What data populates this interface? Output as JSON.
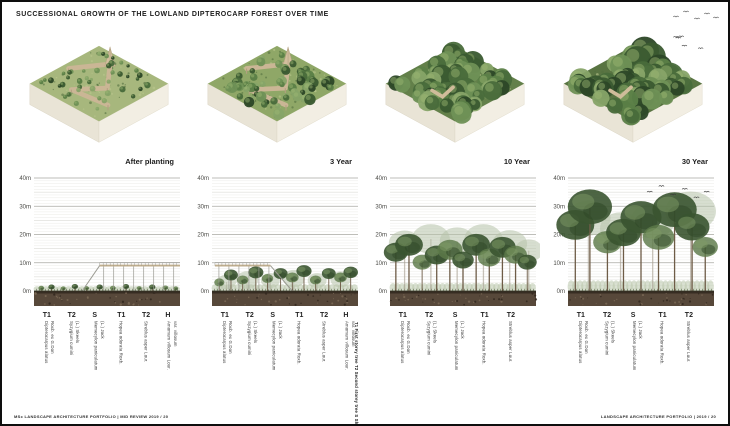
{
  "page": {
    "title": "SUCCESSIONAL GROWTH OF THE LOWLAND DIPTEROCARP FOREST OVER TIME",
    "footer_left": "MSc LANDSCAPE ARCHITECTURE PORTFOLIO  |  MID REVIEW 2019 / 20",
    "footer_right": "LANDSCAPE ARCHITECTURE PORTFOLIO  |  2019 / 20",
    "frame_color": "#0e0e0e",
    "background": "#ffffff",
    "corner_birds": 5
  },
  "layer_key": "T1 First storey tree   T2 Second storey tree   S Shrub   H Herbaceous layer",
  "colors": {
    "section_tones": {
      "dark": "#3a5430",
      "mid": "#5d7a49",
      "pale": "#b6c3aa"
    },
    "iso_palette": [
      "#2c4727",
      "#3a5a30",
      "#496c3b",
      "#5b7f47",
      "#6f9156",
      "#87a468"
    ],
    "boardwalk": "#cab695",
    "soil": "#57483a"
  },
  "panels": [
    {
      "label": "After planting",
      "iso": {
        "seed": 11,
        "ground": "#a7b77d",
        "blob_count": 46,
        "r_min": 1.5,
        "r_max": 3.2,
        "tall": 0,
        "boardwalk": true,
        "tower": true,
        "path_patch": false,
        "birds": false
      },
      "species": [
        {
          "code": "T1",
          "name": "Dipterocarpus alatus",
          "author": "Roxb. ex G.Don"
        },
        {
          "code": "T2",
          "name": "Syzygium cumini",
          "author": "(L.) Skeels"
        },
        {
          "code": "S",
          "name": "Memecylon paniculatum",
          "author": "(L.) Jack"
        },
        {
          "code": "T1",
          "name": "Hopea odorata Roxb.",
          "author": ""
        },
        {
          "code": "T2",
          "name": "Streblus asper Lour.",
          "author": ""
        },
        {
          "code": "H",
          "name": "Amomum villosum Lour.",
          "author": "var. villosum"
        }
      ]
    },
    {
      "label": "3 Year",
      "iso": {
        "seed": 22,
        "ground": "#8fa767",
        "blob_count": 64,
        "r_min": 2.5,
        "r_max": 5.5,
        "tall": 0,
        "boardwalk": true,
        "tower": true,
        "path_patch": false,
        "birds": false
      },
      "species": [
        {
          "code": "T1",
          "name": "Dipterocarpus alatus",
          "author": "Roxb. ex G.Don"
        },
        {
          "code": "T2",
          "name": "Syzygium cumini",
          "author": "(L.) Skeels"
        },
        {
          "code": "S",
          "name": "Memecylon paniculatum",
          "author": "(L.) Jack"
        },
        {
          "code": "T1",
          "name": "Hopea odorata Roxb.",
          "author": ""
        },
        {
          "code": "T2",
          "name": "Streblus asper Lour.",
          "author": ""
        },
        {
          "code": "H",
          "name": "Amomum villosum Lour.",
          "author": "var. villosum"
        }
      ]
    },
    {
      "label": "10 Year",
      "iso": {
        "seed": 33,
        "ground": "#63804a",
        "blob_count": 60,
        "r_min": 5,
        "r_max": 9.5,
        "tall": 4,
        "boardwalk": false,
        "tower": false,
        "path_patch": true,
        "birds": false
      },
      "species": [
        {
          "code": "T1",
          "name": "Dipterocarpus alatus",
          "author": "Roxb. ex G.Don"
        },
        {
          "code": "T2",
          "name": "Syzygium cumini",
          "author": "(L.) Skeels"
        },
        {
          "code": "S",
          "name": "Memecylon paniculatum",
          "author": "(L.) Jack"
        },
        {
          "code": "T1",
          "name": "Hopea odorata Roxb.",
          "author": ""
        },
        {
          "code": "T2",
          "name": "Streblus asper Lour.",
          "author": ""
        }
      ]
    },
    {
      "label": "30 Year",
      "iso": {
        "seed": 44,
        "ground": "#597442",
        "blob_count": 58,
        "r_min": 6,
        "r_max": 11,
        "tall": 7,
        "boardwalk": false,
        "tower": false,
        "path_patch": true,
        "birds": true
      },
      "species": [
        {
          "code": "T1",
          "name": "Dipterocarpus alatus",
          "author": "Roxb. ex G.Don"
        },
        {
          "code": "T2",
          "name": "Syzygium cumini",
          "author": "(L.) Skeels"
        },
        {
          "code": "S",
          "name": "Memecylon paniculatum",
          "author": "(L.) Jack"
        },
        {
          "code": "T1",
          "name": "Hopea odorata Roxb.",
          "author": ""
        },
        {
          "code": "T2",
          "name": "Streblus asper Lour.",
          "author": ""
        }
      ]
    }
  ],
  "chart_data": [
    {
      "type": "area",
      "title": "After planting",
      "ylabel": "Height (m)",
      "ylim": [
        0,
        40
      ],
      "yticks": [
        "0m",
        "10m",
        "20m",
        "30m",
        "40m"
      ],
      "grid": true,
      "understory_m": 1.8,
      "canopy_max_m": 2,
      "boardwalk": {
        "deck_from": 0.45,
        "deck_to": 1.0,
        "height_m": 9,
        "ramp_from": 0.33
      },
      "trees": [
        {
          "x": 0.05,
          "h": 1.6,
          "r": 0.9,
          "tone": "mid"
        },
        {
          "x": 0.12,
          "h": 2.0,
          "r": 1.0,
          "tone": "dark"
        },
        {
          "x": 0.2,
          "h": 1.4,
          "r": 0.8,
          "tone": "mid"
        },
        {
          "x": 0.28,
          "h": 2.2,
          "r": 1.0,
          "tone": "dark"
        },
        {
          "x": 0.36,
          "h": 1.5,
          "r": 0.8,
          "tone": "mid"
        },
        {
          "x": 0.45,
          "h": 2.0,
          "r": 1.0,
          "tone": "dark"
        },
        {
          "x": 0.54,
          "h": 1.6,
          "r": 0.9,
          "tone": "mid"
        },
        {
          "x": 0.63,
          "h": 2.2,
          "r": 1.0,
          "tone": "dark"
        },
        {
          "x": 0.72,
          "h": 1.5,
          "r": 0.8,
          "tone": "mid"
        },
        {
          "x": 0.81,
          "h": 2.0,
          "r": 1.0,
          "tone": "dark"
        },
        {
          "x": 0.9,
          "h": 1.7,
          "r": 0.9,
          "tone": "mid"
        },
        {
          "x": 0.97,
          "h": 1.4,
          "r": 0.8,
          "tone": "mid"
        }
      ],
      "birds_at": []
    },
    {
      "type": "area",
      "title": "3 Year",
      "ylabel": "Height (m)",
      "ylim": [
        0,
        40
      ],
      "yticks": [
        "0m",
        "10m",
        "20m",
        "30m",
        "40m"
      ],
      "grid": true,
      "understory_m": 2.5,
      "canopy_max_m": 9,
      "boardwalk": {
        "deck_from": 0.02,
        "deck_to": 0.4,
        "height_m": 9,
        "ramp_from": 0.55
      },
      "trees": [
        {
          "x": 0.1,
          "h": 5.0,
          "r": 3.0,
          "tone": "pale"
        },
        {
          "x": 0.24,
          "h": 6.0,
          "r": 3.5,
          "tone": "pale"
        },
        {
          "x": 0.4,
          "h": 5.5,
          "r": 3.0,
          "tone": "pale"
        },
        {
          "x": 0.56,
          "h": 6.5,
          "r": 3.5,
          "tone": "pale"
        },
        {
          "x": 0.72,
          "h": 5.5,
          "r": 3.0,
          "tone": "pale"
        },
        {
          "x": 0.88,
          "h": 6.0,
          "r": 3.2,
          "tone": "pale"
        },
        {
          "x": 0.05,
          "h": 4.0,
          "r": 1.6,
          "tone": "mid"
        },
        {
          "x": 0.13,
          "h": 7.0,
          "r": 2.2,
          "tone": "dark"
        },
        {
          "x": 0.21,
          "h": 5.0,
          "r": 1.8,
          "tone": "mid"
        },
        {
          "x": 0.3,
          "h": 8.0,
          "r": 2.4,
          "tone": "dark"
        },
        {
          "x": 0.38,
          "h": 5.5,
          "r": 1.8,
          "tone": "mid"
        },
        {
          "x": 0.47,
          "h": 7.5,
          "r": 2.2,
          "tone": "dark"
        },
        {
          "x": 0.55,
          "h": 6.0,
          "r": 2.0,
          "tone": "mid"
        },
        {
          "x": 0.63,
          "h": 8.5,
          "r": 2.4,
          "tone": "dark"
        },
        {
          "x": 0.71,
          "h": 5.0,
          "r": 1.8,
          "tone": "mid"
        },
        {
          "x": 0.8,
          "h": 7.5,
          "r": 2.2,
          "tone": "dark"
        },
        {
          "x": 0.88,
          "h": 6.0,
          "r": 2.0,
          "tone": "mid"
        },
        {
          "x": 0.95,
          "h": 8.0,
          "r": 2.3,
          "tone": "dark"
        }
      ],
      "birds_at": []
    },
    {
      "type": "area",
      "title": "10 Year",
      "ylabel": "Height (m)",
      "ylim": [
        0,
        40
      ],
      "yticks": [
        "0m",
        "10m",
        "20m",
        "30m",
        "40m"
      ],
      "grid": true,
      "understory_m": 3,
      "canopy_max_m": 22,
      "boardwalk": null,
      "trees": [
        {
          "x": 0.1,
          "h": 20,
          "r": 5.0,
          "tone": "pale"
        },
        {
          "x": 0.28,
          "h": 22,
          "r": 6.0,
          "tone": "pale"
        },
        {
          "x": 0.46,
          "h": 21,
          "r": 5.5,
          "tone": "pale"
        },
        {
          "x": 0.64,
          "h": 22,
          "r": 6.0,
          "tone": "pale"
        },
        {
          "x": 0.82,
          "h": 20,
          "r": 5.5,
          "tone": "pale"
        },
        {
          "x": 0.95,
          "h": 17,
          "r": 4.5,
          "tone": "pale"
        },
        {
          "x": 0.04,
          "h": 16,
          "r": 3.8,
          "tone": "dark"
        },
        {
          "x": 0.13,
          "h": 19,
          "r": 4.4,
          "tone": "dark"
        },
        {
          "x": 0.22,
          "h": 12,
          "r": 3.0,
          "tone": "mid"
        },
        {
          "x": 0.32,
          "h": 15,
          "r": 3.8,
          "tone": "dark"
        },
        {
          "x": 0.41,
          "h": 17,
          "r": 4.0,
          "tone": "mid"
        },
        {
          "x": 0.5,
          "h": 13,
          "r": 3.4,
          "tone": "dark"
        },
        {
          "x": 0.59,
          "h": 19,
          "r": 4.4,
          "tone": "dark"
        },
        {
          "x": 0.68,
          "h": 14,
          "r": 3.6,
          "tone": "mid"
        },
        {
          "x": 0.77,
          "h": 18,
          "r": 4.2,
          "tone": "dark"
        },
        {
          "x": 0.86,
          "h": 15,
          "r": 3.6,
          "tone": "mid"
        },
        {
          "x": 0.94,
          "h": 12,
          "r": 3.0,
          "tone": "dark"
        }
      ],
      "birds_at": []
    },
    {
      "type": "area",
      "title": "30 Year",
      "ylabel": "Height (m)",
      "ylim": [
        0,
        40
      ],
      "yticks": [
        "0m",
        "10m",
        "20m",
        "30m",
        "40m"
      ],
      "grid": true,
      "understory_m": 4,
      "canopy_max_m": 35,
      "boardwalk": null,
      "trees": [
        {
          "x": 0.14,
          "h": 30,
          "r": 7.0,
          "tone": "pale"
        },
        {
          "x": 0.36,
          "h": 26,
          "r": 6.5,
          "tone": "pale"
        },
        {
          "x": 0.58,
          "h": 29,
          "r": 7.0,
          "tone": "pale"
        },
        {
          "x": 0.84,
          "h": 33,
          "r": 8.0,
          "tone": "pale"
        },
        {
          "x": 0.05,
          "h": 27,
          "r": 6.0,
          "tone": "dark"
        },
        {
          "x": 0.15,
          "h": 34,
          "r": 7.0,
          "tone": "dark"
        },
        {
          "x": 0.27,
          "h": 20,
          "r": 4.5,
          "tone": "mid"
        },
        {
          "x": 0.38,
          "h": 24,
          "r": 5.5,
          "tone": "dark"
        },
        {
          "x": 0.5,
          "h": 30,
          "r": 6.5,
          "tone": "dark"
        },
        {
          "x": 0.62,
          "h": 22,
          "r": 5.0,
          "tone": "mid"
        },
        {
          "x": 0.73,
          "h": 33,
          "r": 7.0,
          "tone": "dark"
        },
        {
          "x": 0.85,
          "h": 26,
          "r": 5.5,
          "tone": "dark"
        },
        {
          "x": 0.94,
          "h": 18,
          "r": 4.0,
          "tone": "mid"
        }
      ],
      "birds_at": [
        {
          "x": 0.56,
          "h": 35
        },
        {
          "x": 0.64,
          "h": 37
        },
        {
          "x": 0.72,
          "h": 34
        },
        {
          "x": 0.8,
          "h": 36
        },
        {
          "x": 0.88,
          "h": 33
        },
        {
          "x": 0.95,
          "h": 35
        }
      ]
    }
  ]
}
